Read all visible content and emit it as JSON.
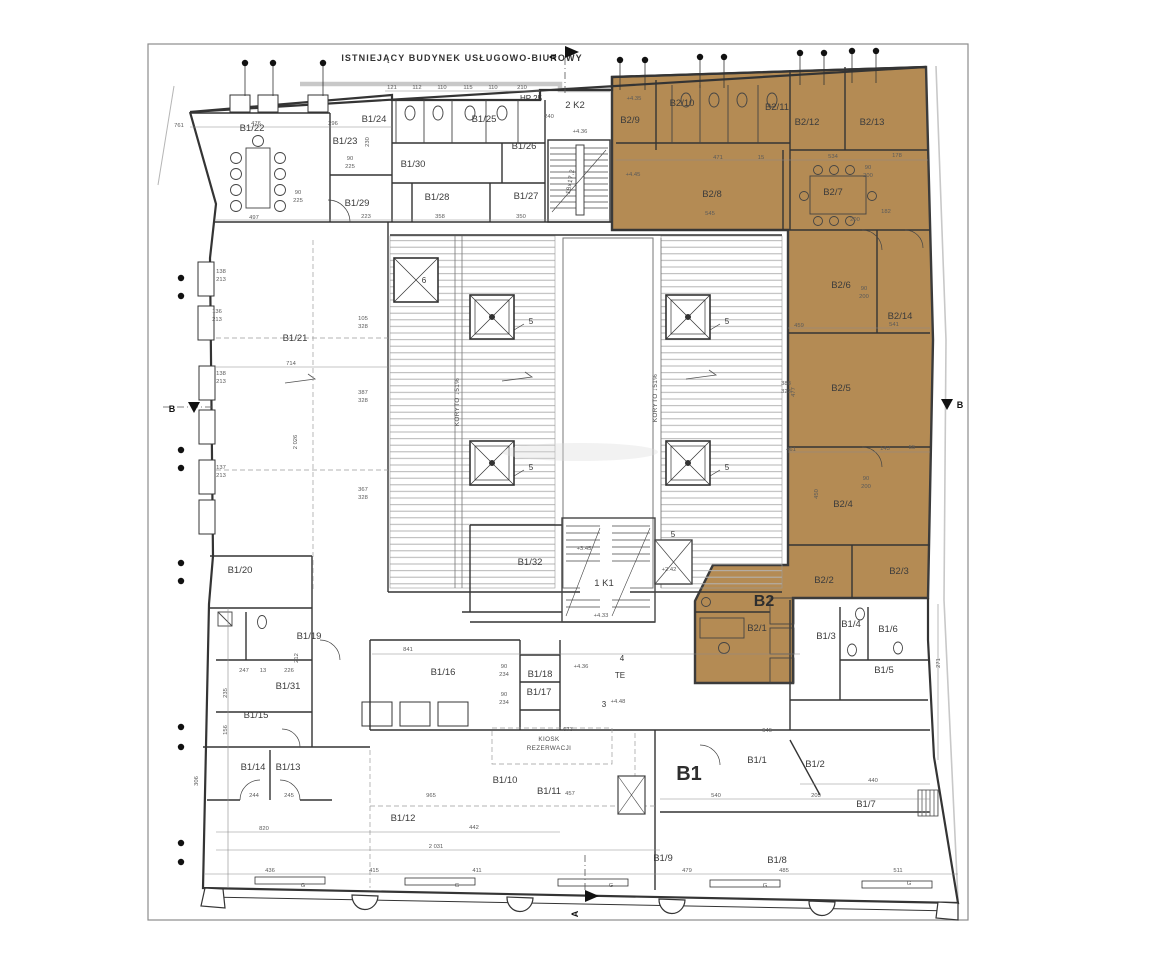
{
  "title": "ISTNIEJĄCY BUDYNEK USŁUGOWO-BIUROWY",
  "highlight_color": "#b48b54",
  "section_markers": {
    "top": "A",
    "bottom": "A",
    "left": "B",
    "right": "B"
  },
  "areas": [
    {
      "t": "B1",
      "x": 689,
      "y": 780,
      "s": 20
    },
    {
      "t": "B2",
      "x": 764,
      "y": 606,
      "s": 16
    }
  ],
  "rooms": [
    {
      "t": "B1/22",
      "x": 252,
      "y": 131
    },
    {
      "t": "B1/23",
      "x": 345,
      "y": 144
    },
    {
      "t": "B1/24",
      "x": 374,
      "y": 122
    },
    {
      "t": "B1/25",
      "x": 484,
      "y": 122
    },
    {
      "t": "B1/26",
      "x": 524,
      "y": 149
    },
    {
      "t": "B1/30",
      "x": 413,
      "y": 167
    },
    {
      "t": "B1/29",
      "x": 357,
      "y": 206
    },
    {
      "t": "B1/28",
      "x": 437,
      "y": 200
    },
    {
      "t": "B1/27",
      "x": 526,
      "y": 199
    },
    {
      "t": "B1/21",
      "x": 295,
      "y": 341
    },
    {
      "t": "B1/20",
      "x": 240,
      "y": 573
    },
    {
      "t": "B1/19",
      "x": 309,
      "y": 639
    },
    {
      "t": "B1/31",
      "x": 288,
      "y": 689
    },
    {
      "t": "B1/15",
      "x": 256,
      "y": 718
    },
    {
      "t": "B1/14",
      "x": 253,
      "y": 770
    },
    {
      "t": "B1/13",
      "x": 288,
      "y": 770
    },
    {
      "t": "B1/16",
      "x": 443,
      "y": 675
    },
    {
      "t": "B1/18",
      "x": 540,
      "y": 677
    },
    {
      "t": "B1/17",
      "x": 539,
      "y": 695
    },
    {
      "t": "B1/32",
      "x": 530,
      "y": 565
    },
    {
      "t": "B1/12",
      "x": 403,
      "y": 821
    },
    {
      "t": "B1/10",
      "x": 505,
      "y": 783
    },
    {
      "t": "B1/11",
      "x": 549,
      "y": 794
    },
    {
      "t": "B1/9",
      "x": 663,
      "y": 861
    },
    {
      "t": "B1/8",
      "x": 777,
      "y": 863
    },
    {
      "t": "B1/1",
      "x": 757,
      "y": 763
    },
    {
      "t": "B1/2",
      "x": 815,
      "y": 767
    },
    {
      "t": "B1/7",
      "x": 866,
      "y": 807
    },
    {
      "t": "B1/3",
      "x": 826,
      "y": 639
    },
    {
      "t": "B1/4",
      "x": 851,
      "y": 627
    },
    {
      "t": "B1/6",
      "x": 888,
      "y": 632
    },
    {
      "t": "B1/5",
      "x": 884,
      "y": 673
    },
    {
      "t": "B2/9",
      "x": 630,
      "y": 123
    },
    {
      "t": "B2/10",
      "x": 682,
      "y": 106
    },
    {
      "t": "B2/11",
      "x": 777,
      "y": 110
    },
    {
      "t": "B2/12",
      "x": 807,
      "y": 125
    },
    {
      "t": "B2/13",
      "x": 872,
      "y": 125
    },
    {
      "t": "B2/8",
      "x": 712,
      "y": 197
    },
    {
      "t": "B2/7",
      "x": 833,
      "y": 195
    },
    {
      "t": "B2/6",
      "x": 841,
      "y": 288
    },
    {
      "t": "B2/14",
      "x": 900,
      "y": 319
    },
    {
      "t": "B2/5",
      "x": 841,
      "y": 391
    },
    {
      "t": "B2/4",
      "x": 843,
      "y": 507
    },
    {
      "t": "B2/3",
      "x": 899,
      "y": 574
    },
    {
      "t": "B2/2",
      "x": 824,
      "y": 583
    },
    {
      "t": "B2/1",
      "x": 757,
      "y": 631
    }
  ],
  "stairs": [
    {
      "t": "2 K2",
      "x": 575,
      "y": 108
    },
    {
      "t": "1 K1",
      "x": 604,
      "y": 586
    }
  ],
  "shafts": [
    {
      "t": "6",
      "x": 424,
      "y": 283
    },
    {
      "t": "5",
      "x": 531,
      "y": 324
    },
    {
      "t": "5",
      "x": 727,
      "y": 324
    },
    {
      "t": "5",
      "x": 531,
      "y": 470
    },
    {
      "t": "5",
      "x": 727,
      "y": 470
    },
    {
      "t": "5",
      "x": 673,
      "y": 537
    },
    {
      "t": "4",
      "x": 622,
      "y": 661
    },
    {
      "t": "3",
      "x": 604,
      "y": 707
    },
    {
      "t": "TE",
      "x": 620,
      "y": 678
    },
    {
      "t": "HP 25",
      "x": 531,
      "y": 101
    }
  ],
  "annotations": [
    {
      "t": "KIOSK",
      "x": 549,
      "y": 741
    },
    {
      "t": "REZERWACJI",
      "x": 549,
      "y": 750
    },
    {
      "t": "KORYTO ↓51%",
      "x": 459,
      "y": 402,
      "r": -90
    },
    {
      "t": "KORYTO ↓51%",
      "x": 657,
      "y": 398,
      "r": -90
    },
    {
      "t": "18x17,2",
      "x": 572,
      "y": 182,
      "r": -80
    }
  ],
  "dims": [
    {
      "t": "761",
      "x": 179,
      "y": 127
    },
    {
      "t": "476",
      "x": 256,
      "y": 125
    },
    {
      "t": "296",
      "x": 333,
      "y": 125
    },
    {
      "t": "121",
      "x": 392,
      "y": 89
    },
    {
      "t": "112",
      "x": 417,
      "y": 89
    },
    {
      "t": "110",
      "x": 442,
      "y": 89
    },
    {
      "t": "115",
      "x": 468,
      "y": 89
    },
    {
      "t": "110",
      "x": 493,
      "y": 89
    },
    {
      "t": "210",
      "x": 522,
      "y": 89
    },
    {
      "t": "497",
      "x": 254,
      "y": 219
    },
    {
      "t": "223",
      "x": 366,
      "y": 218
    },
    {
      "t": "358",
      "x": 440,
      "y": 218
    },
    {
      "t": "350",
      "x": 521,
      "y": 218
    },
    {
      "t": "471",
      "x": 718,
      "y": 159
    },
    {
      "t": "15",
      "x": 761,
      "y": 159
    },
    {
      "t": "534",
      "x": 833,
      "y": 158
    },
    {
      "t": "178",
      "x": 897,
      "y": 157
    },
    {
      "t": "545",
      "x": 710,
      "y": 215
    },
    {
      "t": "200",
      "x": 855,
      "y": 221
    },
    {
      "t": "182",
      "x": 886,
      "y": 213
    },
    {
      "t": "90",
      "x": 350,
      "y": 160
    },
    {
      "t": "225",
      "x": 350,
      "y": 168
    },
    {
      "t": "90",
      "x": 298,
      "y": 194
    },
    {
      "t": "225",
      "x": 298,
      "y": 202
    },
    {
      "t": "+4.36",
      "x": 580,
      "y": 133
    },
    {
      "t": "+4.35",
      "x": 634,
      "y": 100
    },
    {
      "t": "+4.45",
      "x": 633,
      "y": 176
    },
    {
      "t": "459",
      "x": 799,
      "y": 327
    },
    {
      "t": "541",
      "x": 894,
      "y": 326
    },
    {
      "t": "388",
      "x": 786,
      "y": 385
    },
    {
      "t": "323",
      "x": 786,
      "y": 393
    },
    {
      "t": "461",
      "x": 791,
      "y": 451
    },
    {
      "t": "143",
      "x": 885,
      "y": 450
    },
    {
      "t": "55",
      "x": 912,
      "y": 449
    },
    {
      "t": "450",
      "x": 818,
      "y": 494,
      "r": -90
    },
    {
      "t": "477",
      "x": 795,
      "y": 392,
      "r": -90
    },
    {
      "t": "90",
      "x": 868,
      "y": 169
    },
    {
      "t": "200",
      "x": 868,
      "y": 177
    },
    {
      "t": "90",
      "x": 864,
      "y": 290
    },
    {
      "t": "200",
      "x": 864,
      "y": 298
    },
    {
      "t": "90",
      "x": 866,
      "y": 480
    },
    {
      "t": "200",
      "x": 866,
      "y": 488
    },
    {
      "t": "138",
      "x": 221,
      "y": 273
    },
    {
      "t": "213",
      "x": 221,
      "y": 281
    },
    {
      "t": "136",
      "x": 217,
      "y": 313
    },
    {
      "t": "213",
      "x": 217,
      "y": 321
    },
    {
      "t": "138",
      "x": 221,
      "y": 375
    },
    {
      "t": "213",
      "x": 221,
      "y": 383
    },
    {
      "t": "137",
      "x": 221,
      "y": 469
    },
    {
      "t": "213",
      "x": 221,
      "y": 477
    },
    {
      "t": "714",
      "x": 291,
      "y": 365
    },
    {
      "t": "2 026",
      "x": 297,
      "y": 442,
      "r": -90
    },
    {
      "t": "387",
      "x": 363,
      "y": 394
    },
    {
      "t": "328",
      "x": 363,
      "y": 402
    },
    {
      "t": "367",
      "x": 363,
      "y": 491
    },
    {
      "t": "328",
      "x": 363,
      "y": 499
    },
    {
      "t": "105",
      "x": 363,
      "y": 320
    },
    {
      "t": "328",
      "x": 363,
      "y": 328
    },
    {
      "t": "230",
      "x": 369,
      "y": 142,
      "r": -90
    },
    {
      "t": "247",
      "x": 244,
      "y": 672
    },
    {
      "t": "13",
      "x": 263,
      "y": 672
    },
    {
      "t": "226",
      "x": 289,
      "y": 672
    },
    {
      "t": "841",
      "x": 408,
      "y": 651
    },
    {
      "t": "90",
      "x": 504,
      "y": 668
    },
    {
      "t": "234",
      "x": 504,
      "y": 676
    },
    {
      "t": "90",
      "x": 504,
      "y": 696
    },
    {
      "t": "234",
      "x": 504,
      "y": 704
    },
    {
      "t": "212",
      "x": 298,
      "y": 658,
      "r": -90
    },
    {
      "t": "235",
      "x": 227,
      "y": 693,
      "r": -90
    },
    {
      "t": "156",
      "x": 227,
      "y": 730,
      "r": -90
    },
    {
      "t": "306",
      "x": 198,
      "y": 781,
      "r": -90
    },
    {
      "t": "244",
      "x": 254,
      "y": 797
    },
    {
      "t": "245",
      "x": 289,
      "y": 797
    },
    {
      "t": "820",
      "x": 264,
      "y": 830
    },
    {
      "t": "436",
      "x": 270,
      "y": 872
    },
    {
      "t": "415",
      "x": 374,
      "y": 872
    },
    {
      "t": "411",
      "x": 477,
      "y": 872
    },
    {
      "t": "479",
      "x": 687,
      "y": 872
    },
    {
      "t": "485",
      "x": 784,
      "y": 872
    },
    {
      "t": "511",
      "x": 898,
      "y": 872
    },
    {
      "t": "965",
      "x": 431,
      "y": 797
    },
    {
      "t": "2 031",
      "x": 436,
      "y": 848
    },
    {
      "t": "442",
      "x": 474,
      "y": 829
    },
    {
      "t": "457",
      "x": 570,
      "y": 795
    },
    {
      "t": "673",
      "x": 568,
      "y": 731
    },
    {
      "t": "646",
      "x": 767,
      "y": 732
    },
    {
      "t": "540",
      "x": 716,
      "y": 797
    },
    {
      "t": "205",
      "x": 816,
      "y": 797
    },
    {
      "t": "440",
      "x": 873,
      "y": 782
    },
    {
      "t": "271",
      "x": 940,
      "y": 663,
      "r": -90
    },
    {
      "t": "+4.33",
      "x": 601,
      "y": 617
    },
    {
      "t": "+4.36",
      "x": 581,
      "y": 668
    },
    {
      "t": "+4.48",
      "x": 618,
      "y": 703
    },
    {
      "t": "+2.42",
      "x": 669,
      "y": 571
    },
    {
      "t": "+3.45",
      "x": 584,
      "y": 550
    },
    {
      "t": "240",
      "x": 549,
      "y": 118
    },
    {
      "t": "G",
      "x": 303,
      "y": 887
    },
    {
      "t": "G",
      "x": 457,
      "y": 887
    },
    {
      "t": "G",
      "x": 611,
      "y": 887
    },
    {
      "t": "G",
      "x": 765,
      "y": 887
    },
    {
      "t": "G",
      "x": 909,
      "y": 885
    }
  ]
}
